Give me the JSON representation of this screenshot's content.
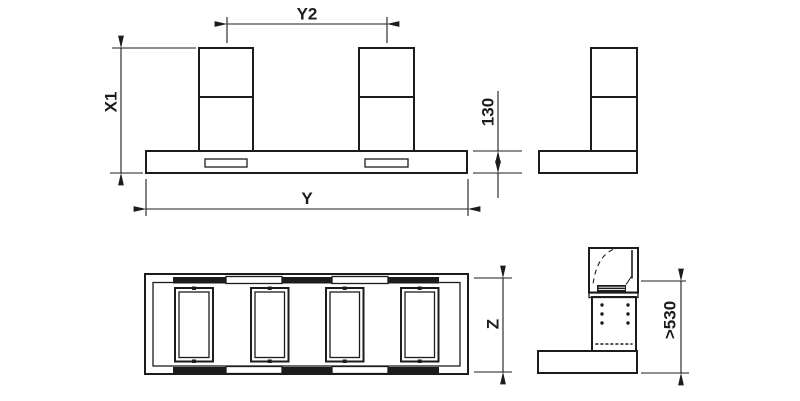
{
  "colors": {
    "line": "#1c1c1c",
    "background": "#ffffff"
  },
  "dimensions": {
    "y2": "Y2",
    "x1": "X1",
    "base_height": "130",
    "y": "Y",
    "z": "Z",
    "clearance": ">530"
  }
}
